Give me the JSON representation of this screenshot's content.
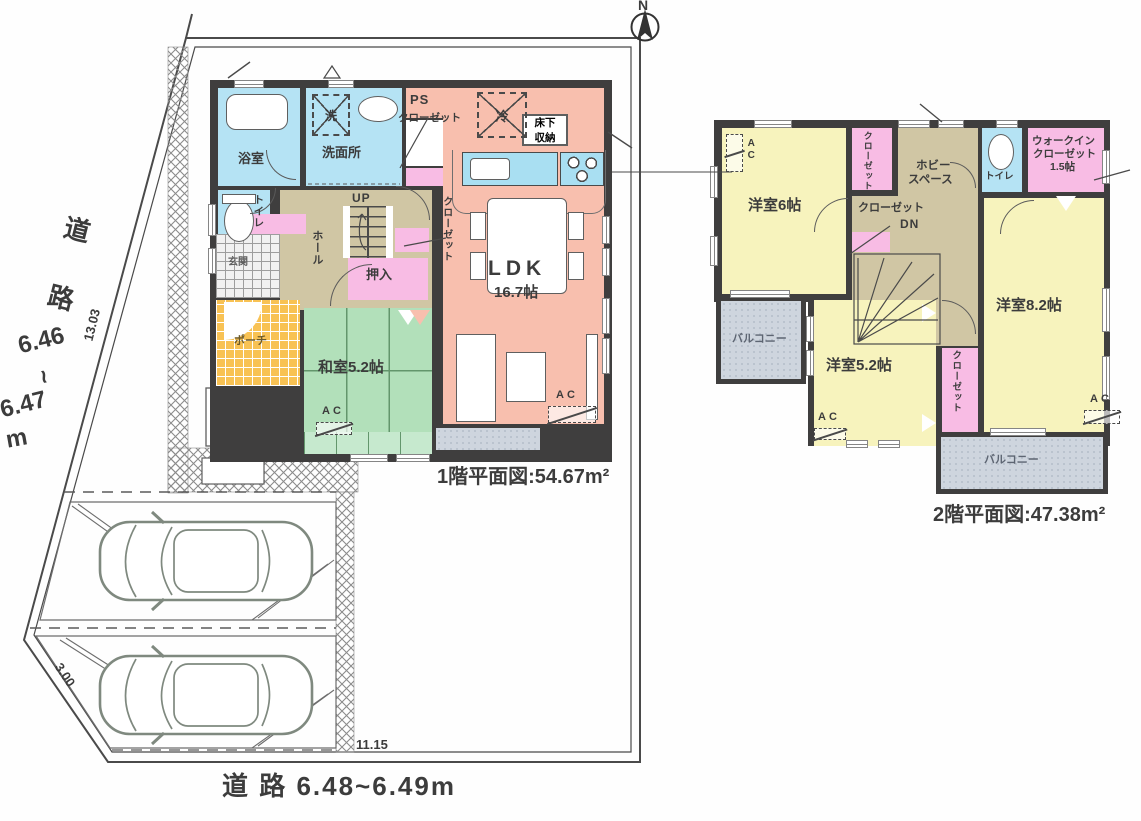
{
  "north_label": "N",
  "roads": {
    "left_kanji": [
      "道",
      "路"
    ],
    "left_dims": [
      "6.46",
      "~",
      "6.47",
      "m"
    ],
    "bottom": "道 路 6.48~6.49m"
  },
  "site": {
    "dim_left": "13.03",
    "dim_corner": "3.00",
    "dim_bottom": "11.15"
  },
  "floor1": {
    "caption": "1階平面図:54.67m²",
    "rooms": {
      "bath": "浴室",
      "washroom": "洗面所",
      "washer": "洗",
      "ps": "PS",
      "closet_top": "クローゼット",
      "toilet": "トイレ",
      "up": "UP",
      "hall": "ホール",
      "closet_stairs": "クローゼット",
      "oshiire": "押入",
      "genkan": "玄関",
      "porch": "ポーチ",
      "washitsu": "和室5.2帖",
      "ldk": "LDK",
      "ldk_size": "16.7帖",
      "fridge": "冷",
      "floor_storage_1": "床下",
      "floor_storage_2": "収納",
      "ac": "AC"
    }
  },
  "floor2": {
    "caption": "2階平面図:47.38m²",
    "rooms": {
      "room6": "洋室6帖",
      "closet6": "クローゼット",
      "hobby_1": "ホビー",
      "hobby_2": "スペース",
      "toilet": "トイレ",
      "wic_1": "ウォークイン",
      "wic_2": "クローゼット",
      "wic_3": "1.5帖",
      "closet_center": "クローゼット",
      "dn": "DN",
      "room82": "洋室8.2帖",
      "room52": "洋室5.2帖",
      "closet_mid": "クローゼット",
      "balcony_left": "バルコニー",
      "balcony_bottom": "バルコニー",
      "ac": "AC"
    }
  },
  "colors": {
    "wall": "#3f3e3e",
    "ldk_salmon": "#f8bfae",
    "water_blue": "#b5e3f4",
    "tatami_green": "#b2e0ba",
    "closet_pink": "#f8bce4",
    "hall_tan": "#d0c6a4",
    "porch_orange": "#f8c254",
    "room_yellow": "#f7f3bd",
    "balcony_gray": "#ced5de"
  }
}
